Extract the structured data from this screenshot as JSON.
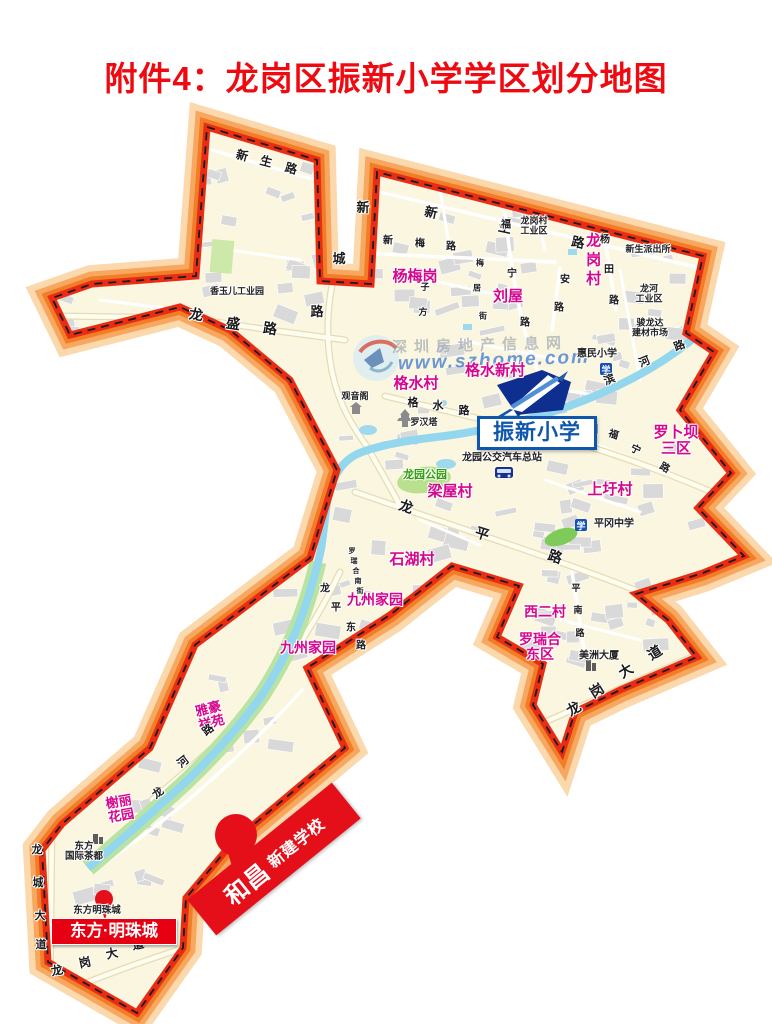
{
  "title": "附件4：龙岗区振新小学学区划分地图",
  "watermark": {
    "org": "深圳房地产信息网",
    "url": "www.szhome.com"
  },
  "school_callout": {
    "name": "振新小学"
  },
  "new_school_marker": {
    "brand": "和昌",
    "desc": "新建学校"
  },
  "estate_badge": {
    "name": "东方·明珠城"
  },
  "labels": {
    "villages": [
      {
        "t": "杨梅岗",
        "x": 415,
        "y": 277,
        "fs": 15
      },
      {
        "t": "刘屋",
        "x": 508,
        "y": 297,
        "fs": 15
      },
      {
        "t": "龙岗村",
        "x": 592,
        "y": 261,
        "fs": 15,
        "v": 1
      },
      {
        "t": "格水新村",
        "x": 495,
        "y": 371,
        "fs": 15
      },
      {
        "t": "格水村",
        "x": 416,
        "y": 384,
        "fs": 15
      },
      {
        "t": "罗卜坝\n三区",
        "x": 676,
        "y": 441,
        "fs": 15
      },
      {
        "t": "上圩村",
        "x": 610,
        "y": 490,
        "fs": 15
      },
      {
        "t": "梁屋村",
        "x": 450,
        "y": 492,
        "fs": 15
      },
      {
        "t": "石湖村",
        "x": 412,
        "y": 560,
        "fs": 15
      },
      {
        "t": "九州家园",
        "x": 375,
        "y": 600,
        "fs": 14
      },
      {
        "t": "九州家园",
        "x": 308,
        "y": 648,
        "fs": 14
      },
      {
        "t": "西二村",
        "x": 545,
        "y": 612,
        "fs": 14
      },
      {
        "t": "罗瑞合\n东区",
        "x": 540,
        "y": 647,
        "fs": 14
      },
      {
        "t": "雅豪\n祥苑",
        "x": 210,
        "y": 716,
        "fs": 13,
        "r": -14
      },
      {
        "t": "榭丽\n花园",
        "x": 120,
        "y": 809,
        "fs": 13,
        "r": -10
      }
    ],
    "places": [
      {
        "t": "香玉儿工业园",
        "x": 237,
        "y": 292,
        "fs": 9
      },
      {
        "t": "龙岗村\n工业区",
        "x": 534,
        "y": 226,
        "fs": 9
      },
      {
        "t": "新生派出所",
        "x": 648,
        "y": 250,
        "fs": 9
      },
      {
        "t": "龙河\n工业区",
        "x": 649,
        "y": 294,
        "fs": 9
      },
      {
        "t": "骏龙达\n建材市场",
        "x": 650,
        "y": 328,
        "fs": 9
      },
      {
        "t": "惠民小学",
        "x": 597,
        "y": 355,
        "fs": 10
      },
      {
        "t": "罗汉塔",
        "x": 424,
        "y": 423,
        "fs": 9
      },
      {
        "t": "观音阁",
        "x": 355,
        "y": 397,
        "fs": 9
      },
      {
        "t": "龙园公交汽车总站",
        "x": 502,
        "y": 459,
        "fs": 10
      },
      {
        "t": "平冈中学",
        "x": 614,
        "y": 525,
        "fs": 10
      },
      {
        "t": "美洲大厦",
        "x": 599,
        "y": 657,
        "fs": 10
      },
      {
        "t": "东方\n国际茶都",
        "x": 84,
        "y": 852,
        "fs": 9.5
      },
      {
        "t": "东方明珠城",
        "x": 97,
        "y": 911,
        "fs": 9.5
      },
      {
        "t": "龙园公园",
        "x": 425,
        "y": 476,
        "fs": 11,
        "c": "green"
      }
    ],
    "roads": [
      {
        "t": "新",
        "x": 242,
        "y": 156,
        "fs": 12,
        "r": 15
      },
      {
        "t": "生",
        "x": 266,
        "y": 162,
        "fs": 12,
        "r": 15
      },
      {
        "t": "路",
        "x": 291,
        "y": 169,
        "fs": 12,
        "r": 15
      },
      {
        "t": "新",
        "x": 431,
        "y": 213,
        "fs": 13,
        "r": 12
      },
      {
        "t": "生",
        "x": 505,
        "y": 228,
        "fs": 13,
        "r": 12
      },
      {
        "t": "路",
        "x": 578,
        "y": 243,
        "fs": 13,
        "r": 12
      },
      {
        "t": "新",
        "x": 363,
        "y": 208,
        "fs": 13
      },
      {
        "t": "城",
        "x": 339,
        "y": 259,
        "fs": 13
      },
      {
        "t": "路",
        "x": 317,
        "y": 312,
        "fs": 13
      },
      {
        "t": "龙",
        "x": 196,
        "y": 315,
        "fs": 14,
        "r": 8
      },
      {
        "t": "盛",
        "x": 233,
        "y": 324,
        "fs": 14,
        "r": 8
      },
      {
        "t": "路",
        "x": 270,
        "y": 329,
        "fs": 14,
        "r": 8
      },
      {
        "t": "新",
        "x": 388,
        "y": 242,
        "fs": 10
      },
      {
        "t": "梅",
        "x": 420,
        "y": 245,
        "fs": 10
      },
      {
        "t": "路",
        "x": 451,
        "y": 248,
        "fs": 10
      },
      {
        "t": "福",
        "x": 506,
        "y": 226,
        "fs": 10
      },
      {
        "t": "宁",
        "x": 512,
        "y": 275,
        "fs": 10
      },
      {
        "t": "路",
        "x": 525,
        "y": 324,
        "fs": 10
      },
      {
        "t": "安",
        "x": 565,
        "y": 281,
        "fs": 10
      },
      {
        "t": "路",
        "x": 559,
        "y": 309,
        "fs": 10
      },
      {
        "t": "杨",
        "x": 605,
        "y": 241,
        "fs": 10
      },
      {
        "t": "田",
        "x": 609,
        "y": 271,
        "fs": 10
      },
      {
        "t": "路",
        "x": 614,
        "y": 302,
        "fs": 10
      },
      {
        "t": "梅",
        "x": 480,
        "y": 264,
        "fs": 8
      },
      {
        "t": "居",
        "x": 477,
        "y": 289,
        "fs": 8
      },
      {
        "t": "街",
        "x": 483,
        "y": 317,
        "fs": 8
      },
      {
        "t": "子",
        "x": 425,
        "y": 288,
        "fs": 9
      },
      {
        "t": "方",
        "x": 423,
        "y": 313,
        "fs": 9
      },
      {
        "t": "格",
        "x": 413,
        "y": 404,
        "fs": 11
      },
      {
        "t": "水",
        "x": 438,
        "y": 407,
        "fs": 11
      },
      {
        "t": "路",
        "x": 464,
        "y": 412,
        "fs": 11
      },
      {
        "t": "滨",
        "x": 610,
        "y": 381,
        "fs": 11,
        "r": -22
      },
      {
        "t": "河",
        "x": 645,
        "y": 363,
        "fs": 11,
        "r": -22
      },
      {
        "t": "路",
        "x": 680,
        "y": 347,
        "fs": 11,
        "r": -22
      },
      {
        "t": "园",
        "x": 593,
        "y": 431,
        "fs": 10
      },
      {
        "t": "福",
        "x": 613,
        "y": 436,
        "fs": 10,
        "r": 20
      },
      {
        "t": "宁",
        "x": 635,
        "y": 451,
        "fs": 10,
        "r": 25
      },
      {
        "t": "路",
        "x": 664,
        "y": 469,
        "fs": 10,
        "r": 30
      },
      {
        "t": "龙",
        "x": 406,
        "y": 507,
        "fs": 14,
        "r": 18
      },
      {
        "t": "平",
        "x": 482,
        "y": 534,
        "fs": 14,
        "r": 18
      },
      {
        "t": "路",
        "x": 555,
        "y": 557,
        "fs": 14,
        "r": 18
      },
      {
        "t": "龙",
        "x": 325,
        "y": 590,
        "fs": 10
      },
      {
        "t": "平",
        "x": 336,
        "y": 609,
        "fs": 10
      },
      {
        "t": "东",
        "x": 351,
        "y": 629,
        "fs": 10
      },
      {
        "t": "路",
        "x": 361,
        "y": 647,
        "fs": 10
      },
      {
        "t": "罗",
        "x": 352,
        "y": 552,
        "fs": 7
      },
      {
        "t": "瑞",
        "x": 354,
        "y": 562,
        "fs": 7
      },
      {
        "t": "合",
        "x": 356,
        "y": 572,
        "fs": 7
      },
      {
        "t": "南",
        "x": 358,
        "y": 582,
        "fs": 7
      },
      {
        "t": "街",
        "x": 360,
        "y": 592,
        "fs": 7
      },
      {
        "t": "路",
        "x": 209,
        "y": 731,
        "fs": 11,
        "r": -38
      },
      {
        "t": "河",
        "x": 184,
        "y": 763,
        "fs": 11,
        "r": -38
      },
      {
        "t": "龙",
        "x": 159,
        "y": 794,
        "fs": 11,
        "r": -38
      },
      {
        "t": "平",
        "x": 576,
        "y": 589,
        "fs": 9
      },
      {
        "t": "南",
        "x": 578,
        "y": 611,
        "fs": 9
      },
      {
        "t": "路",
        "x": 580,
        "y": 634,
        "fs": 9
      },
      {
        "t": "龙",
        "x": 37,
        "y": 851,
        "fs": 11
      },
      {
        "t": "城",
        "x": 38,
        "y": 884,
        "fs": 11
      },
      {
        "t": "大",
        "x": 40,
        "y": 917,
        "fs": 11
      },
      {
        "t": "道",
        "x": 41,
        "y": 946,
        "fs": 11
      },
      {
        "t": "龙",
        "x": 57,
        "y": 971,
        "fs": 12,
        "r": -12
      },
      {
        "t": "岗",
        "x": 85,
        "y": 963,
        "fs": 12,
        "r": -12
      },
      {
        "t": "大",
        "x": 112,
        "y": 954,
        "fs": 12,
        "r": -12
      },
      {
        "t": "道",
        "x": 138,
        "y": 945,
        "fs": 12,
        "r": -12
      },
      {
        "t": "龙",
        "x": 574,
        "y": 709,
        "fs": 14,
        "r": -32
      },
      {
        "t": "岗",
        "x": 597,
        "y": 691,
        "fs": 14,
        "r": -32
      },
      {
        "t": "大",
        "x": 626,
        "y": 671,
        "fs": 14,
        "r": -32
      },
      {
        "t": "道",
        "x": 655,
        "y": 653,
        "fs": 14,
        "r": -32
      }
    ]
  }
}
